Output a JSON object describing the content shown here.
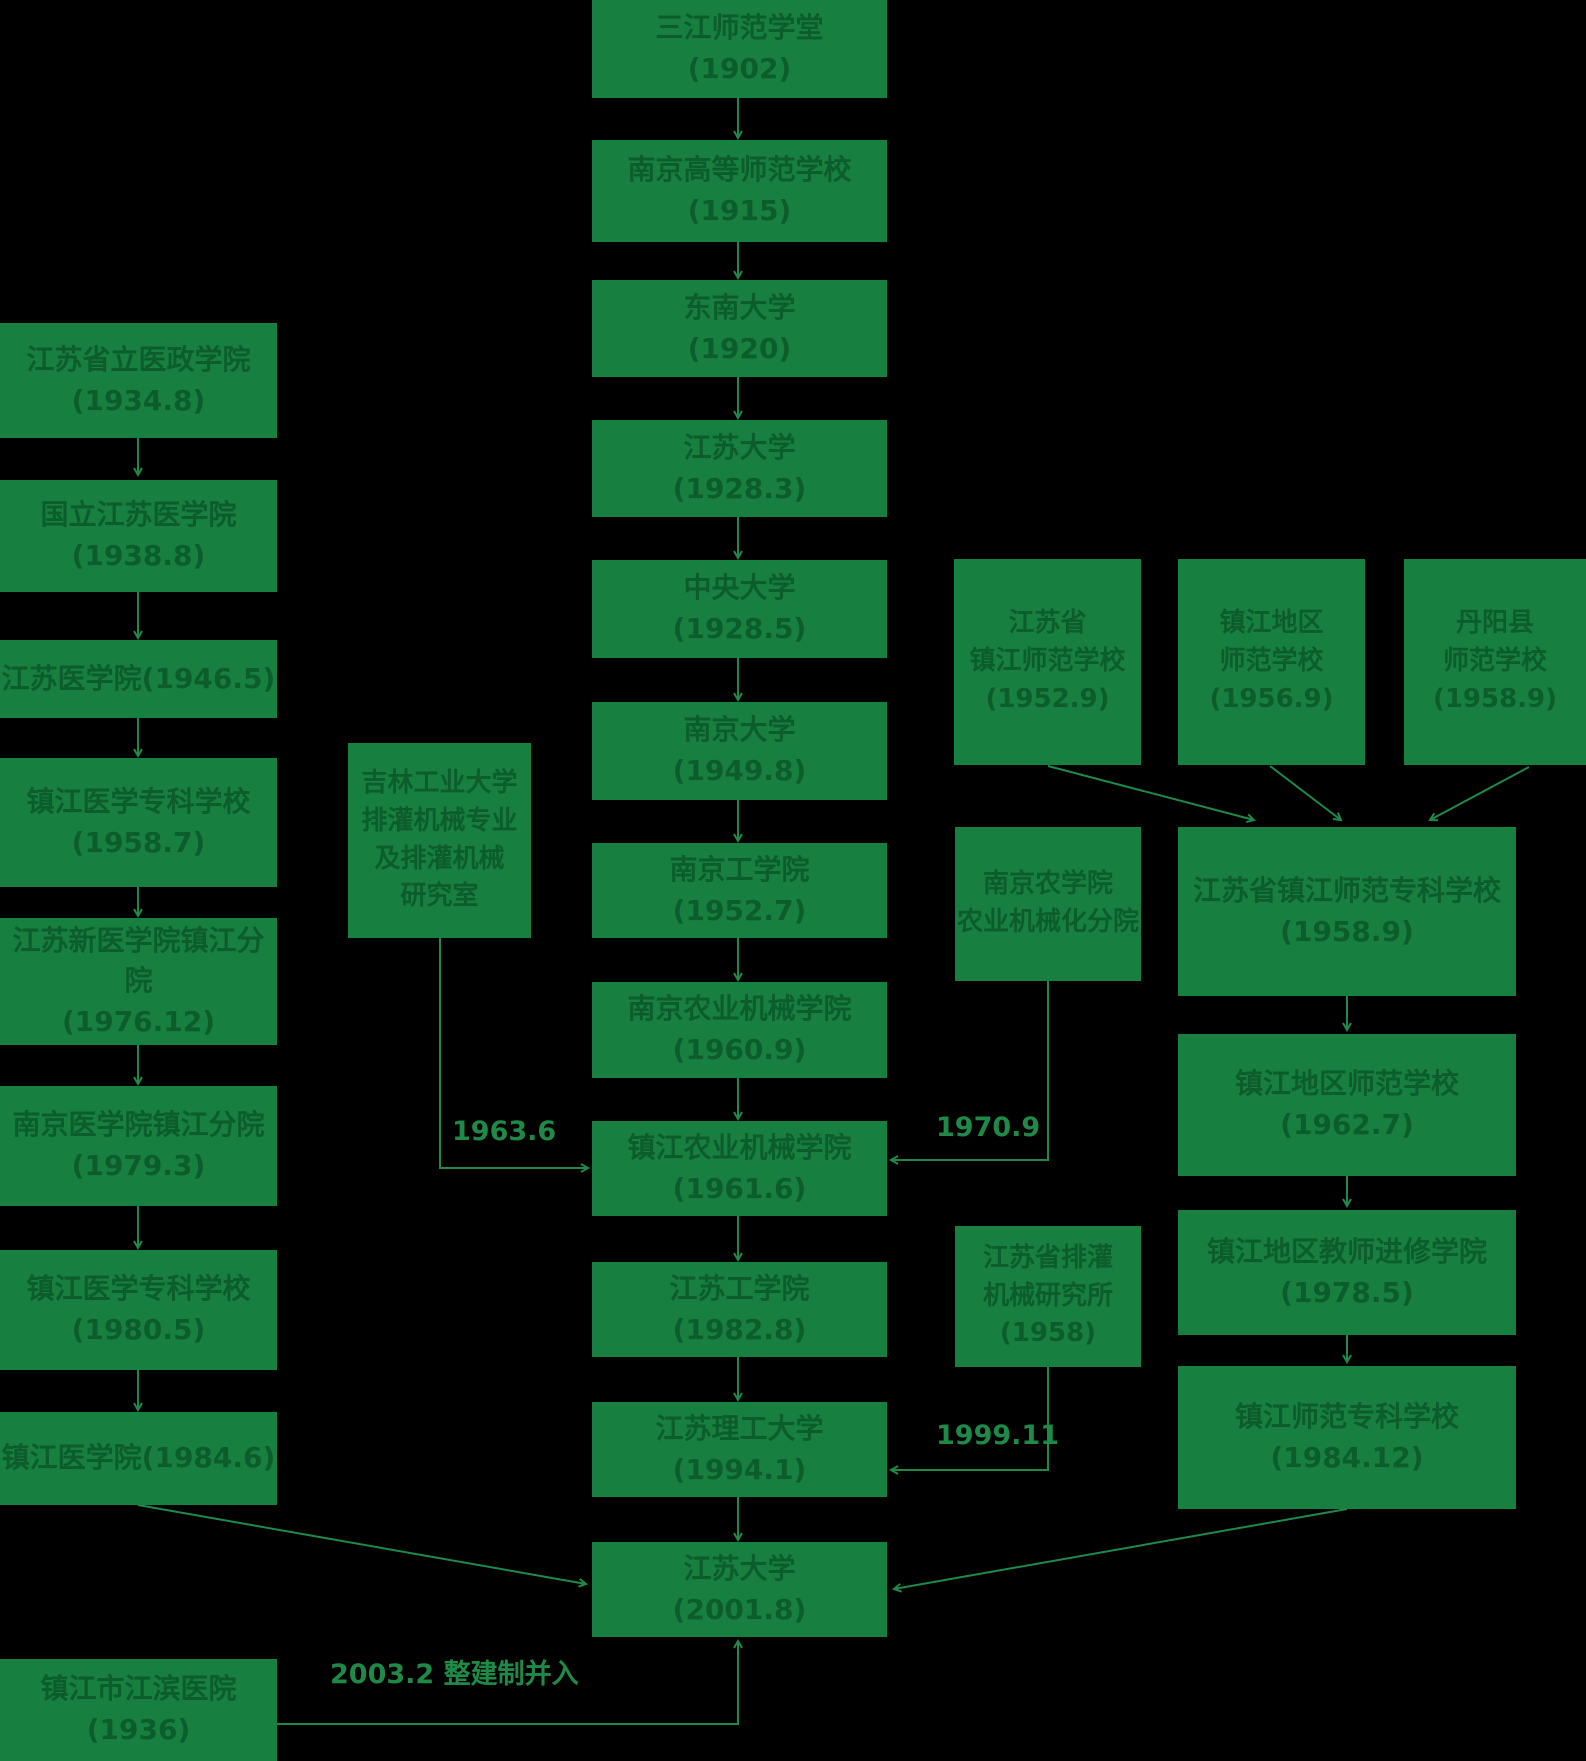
{
  "diagram": {
    "colors": {
      "background": "#000000",
      "node_fill": "#178040",
      "node_text": "#0d5c2b",
      "line": "#1f8a48"
    },
    "nodes": [
      {
        "id": "sanjiang-1902",
        "lines": [
          "三江师范学堂",
          "(1902)"
        ],
        "x": 592,
        "y": 0,
        "w": 295,
        "h": 98
      },
      {
        "id": "nanjing-gaoshi-1915",
        "lines": [
          "南京高等师范学校",
          "(1915)"
        ],
        "x": 592,
        "y": 140,
        "w": 295,
        "h": 102
      },
      {
        "id": "dongnan-1920",
        "lines": [
          "东南大学",
          "(1920)"
        ],
        "x": 592,
        "y": 280,
        "w": 295,
        "h": 97
      },
      {
        "id": "jiangsu-daxue-1928",
        "lines": [
          "江苏大学",
          "(1928.3)"
        ],
        "x": 592,
        "y": 420,
        "w": 295,
        "h": 97
      },
      {
        "id": "zhongyang-daxue-1928",
        "lines": [
          "中央大学",
          "(1928.5)"
        ],
        "x": 592,
        "y": 560,
        "w": 295,
        "h": 98
      },
      {
        "id": "nanjing-daxue-1949",
        "lines": [
          "南京大学",
          "(1949.8)"
        ],
        "x": 592,
        "y": 702,
        "w": 295,
        "h": 98
      },
      {
        "id": "nanjing-gongxueyuan-1952",
        "lines": [
          "南京工学院",
          "(1952.7)"
        ],
        "x": 592,
        "y": 843,
        "w": 295,
        "h": 95
      },
      {
        "id": "nanjing-nongji-1960",
        "lines": [
          "南京农业机械学院",
          "(1960.9)"
        ],
        "x": 592,
        "y": 982,
        "w": 295,
        "h": 96
      },
      {
        "id": "zhenjiang-nongji-1961",
        "lines": [
          "镇江农业机械学院",
          "(1961.6)"
        ],
        "x": 592,
        "y": 1121,
        "w": 295,
        "h": 95
      },
      {
        "id": "jiangsu-gongxueyuan-1982",
        "lines": [
          "江苏工学院",
          "(1982.8)"
        ],
        "x": 592,
        "y": 1262,
        "w": 295,
        "h": 95
      },
      {
        "id": "jiangsu-ligong-1994",
        "lines": [
          "江苏理工大学",
          "(1994.1)"
        ],
        "x": 592,
        "y": 1402,
        "w": 295,
        "h": 95
      },
      {
        "id": "jiangsu-daxue-2001",
        "lines": [
          "江苏大学",
          "(2001.8)"
        ],
        "x": 592,
        "y": 1542,
        "w": 295,
        "h": 95
      },
      {
        "id": "yizheng-xueyuan-1934",
        "lines": [
          "江苏省立医政学院",
          "(1934.8)"
        ],
        "x": 0,
        "y": 323,
        "w": 277,
        "h": 115
      },
      {
        "id": "guoli-jiangsu-yixueyuan-1938",
        "lines": [
          "国立江苏医学院",
          "(1938.8)"
        ],
        "x": 0,
        "y": 480,
        "w": 277,
        "h": 112
      },
      {
        "id": "jiangsu-yixueyuan-1946",
        "lines": [
          "江苏医学院(1946.5)"
        ],
        "x": 0,
        "y": 640,
        "w": 277,
        "h": 78
      },
      {
        "id": "zhenjiang-yizhuan-1958",
        "lines": [
          "镇江医学专科学校",
          "(1958.7)"
        ],
        "x": 0,
        "y": 758,
        "w": 277,
        "h": 129
      },
      {
        "id": "xinyi-zhenjiang-fenyuan-1976",
        "lines": [
          "江苏新医学院镇江分院",
          "(1976.12)"
        ],
        "x": 0,
        "y": 918,
        "w": 277,
        "h": 127
      },
      {
        "id": "nanyi-zhenjiang-fenyuan-1979",
        "lines": [
          "南京医学院镇江分院",
          "(1979.3)"
        ],
        "x": 0,
        "y": 1086,
        "w": 277,
        "h": 120
      },
      {
        "id": "zhenjiang-yizhuan-1980",
        "lines": [
          "镇江医学专科学校",
          "(1980.5)"
        ],
        "x": 0,
        "y": 1250,
        "w": 277,
        "h": 120
      },
      {
        "id": "zhenjiang-yixueyuan-1984",
        "lines": [
          "镇江医学院(1984.6)"
        ],
        "x": 0,
        "y": 1412,
        "w": 277,
        "h": 93
      },
      {
        "id": "jiangbin-yiyuan-1936",
        "lines": [
          "镇江市江滨医院",
          "(1936)"
        ],
        "x": 0,
        "y": 1659,
        "w": 277,
        "h": 102
      },
      {
        "id": "jilin-paiguan-1963",
        "lines": [
          "吉林工业大学",
          "排灌机械专业",
          "及排灌机械",
          "研究室"
        ],
        "x": 348,
        "y": 743,
        "w": 183,
        "h": 195
      },
      {
        "id": "zhenjiang-shifan-1952",
        "lines": [
          "江苏省",
          "镇江师范学校",
          "(1952.9)"
        ],
        "x": 954,
        "y": 559,
        "w": 187,
        "h": 206
      },
      {
        "id": "diqu-shifan-1956",
        "lines": [
          "镇江地区",
          "师范学校",
          "(1956.9)"
        ],
        "x": 1178,
        "y": 559,
        "w": 187,
        "h": 206
      },
      {
        "id": "danyang-shifan-1958",
        "lines": [
          "丹阳县",
          "师范学校",
          "(1958.9)"
        ],
        "x": 1404,
        "y": 559,
        "w": 182,
        "h": 206
      },
      {
        "id": "nongxueyuan-fenyuan",
        "lines": [
          "南京农学院",
          "农业机械化分院"
        ],
        "x": 955,
        "y": 827,
        "w": 186,
        "h": 154
      },
      {
        "id": "zhenjiang-shizhuan-1958",
        "lines": [
          "江苏省镇江师范专科学校",
          "(1958.9)"
        ],
        "x": 1178,
        "y": 827,
        "w": 338,
        "h": 169
      },
      {
        "id": "diqu-shifan-1962",
        "lines": [
          "镇江地区师范学校",
          "(1962.7)"
        ],
        "x": 1178,
        "y": 1034,
        "w": 338,
        "h": 142
      },
      {
        "id": "jiaoshi-jinxiu-1978",
        "lines": [
          "镇江地区教师进修学院",
          "(1978.5)"
        ],
        "x": 1178,
        "y": 1210,
        "w": 338,
        "h": 125
      },
      {
        "id": "zhenjiang-shizhuan-1984",
        "lines": [
          "镇江师范专科学校",
          "(1984.12)"
        ],
        "x": 1178,
        "y": 1366,
        "w": 338,
        "h": 143
      },
      {
        "id": "paiguan-yanjiusuo",
        "lines": [
          "江苏省排灌",
          "机械研究所",
          "(1958)"
        ],
        "x": 955,
        "y": 1226,
        "w": 186,
        "h": 141
      }
    ],
    "edges": [
      {
        "name": "sanjiang-to-gaoshi",
        "points": [
          [
            738,
            98
          ],
          [
            738,
            138
          ]
        ]
      },
      {
        "name": "gaoshi-to-dongnan",
        "points": [
          [
            738,
            242
          ],
          [
            738,
            278
          ]
        ]
      },
      {
        "name": "dongnan-to-jiangsudaxue",
        "points": [
          [
            738,
            377
          ],
          [
            738,
            418
          ]
        ]
      },
      {
        "name": "jiangsudaxue-to-zhongyang",
        "points": [
          [
            738,
            517
          ],
          [
            738,
            558
          ]
        ]
      },
      {
        "name": "zhongyang-to-nanjingdaxue",
        "points": [
          [
            738,
            658
          ],
          [
            738,
            700
          ]
        ]
      },
      {
        "name": "nanjingdaxue-to-gongxueyuan",
        "points": [
          [
            738,
            800
          ],
          [
            738,
            841
          ]
        ]
      },
      {
        "name": "gongxueyuan-to-nongji",
        "points": [
          [
            738,
            938
          ],
          [
            738,
            980
          ]
        ]
      },
      {
        "name": "nongji-to-zhenjiangnongji",
        "points": [
          [
            738,
            1078
          ],
          [
            738,
            1119
          ]
        ]
      },
      {
        "name": "zhenjiangnongji-to-gongxueyuan1982",
        "points": [
          [
            738,
            1216
          ],
          [
            738,
            1260
          ]
        ]
      },
      {
        "name": "gongxueyuan1982-to-ligong",
        "points": [
          [
            738,
            1357
          ],
          [
            738,
            1400
          ]
        ]
      },
      {
        "name": "ligong-to-jiangsudaxue2001",
        "points": [
          [
            738,
            1497
          ],
          [
            738,
            1540
          ]
        ]
      },
      {
        "name": "yizheng-to-guoli",
        "points": [
          [
            138,
            438
          ],
          [
            138,
            475
          ]
        ]
      },
      {
        "name": "guoli-to-yixueyuan",
        "points": [
          [
            138,
            592
          ],
          [
            138,
            638
          ]
        ]
      },
      {
        "name": "yixueyuan-to-yizhuan",
        "points": [
          [
            138,
            718
          ],
          [
            138,
            756
          ]
        ]
      },
      {
        "name": "yizhuan-to-xinyi",
        "points": [
          [
            138,
            887
          ],
          [
            138,
            916
          ]
        ]
      },
      {
        "name": "xinyi-to-nanyi",
        "points": [
          [
            138,
            1045
          ],
          [
            138,
            1084
          ]
        ]
      },
      {
        "name": "nanyi-to-yizhuan1980",
        "points": [
          [
            138,
            1206
          ],
          [
            138,
            1248
          ]
        ]
      },
      {
        "name": "yizhuan1980-to-yixueyuan1984",
        "points": [
          [
            138,
            1370
          ],
          [
            138,
            1410
          ]
        ]
      },
      {
        "name": "yixueyuan1984-to-jiangsudaxue2001",
        "points": [
          [
            138,
            1505
          ],
          [
            586,
            1584
          ]
        ]
      },
      {
        "name": "shizhuan1984-to-jiangsudaxue2001",
        "points": [
          [
            1347,
            1509
          ],
          [
            894,
            1589
          ]
        ]
      },
      {
        "name": "shifan1952-to-shizhuan",
        "points": [
          [
            1048,
            766
          ],
          [
            1254,
            820
          ]
        ]
      },
      {
        "name": "diqushifan-to-shizhuan",
        "points": [
          [
            1270,
            766
          ],
          [
            1341,
            820
          ]
        ]
      },
      {
        "name": "danyang-to-shizhuan",
        "points": [
          [
            1529,
            767
          ],
          [
            1430,
            820
          ]
        ]
      },
      {
        "name": "shizhuan-to-diqushifan1962",
        "points": [
          [
            1347,
            996
          ],
          [
            1347,
            1030
          ]
        ]
      },
      {
        "name": "diqushifan1962-to-jinxiu",
        "points": [
          [
            1347,
            1176
          ],
          [
            1347,
            1206
          ]
        ]
      },
      {
        "name": "jinxiu-to-shizhuan1984",
        "points": [
          [
            1347,
            1335
          ],
          [
            1347,
            1362
          ]
        ]
      },
      {
        "name": "jilin-1963-merge",
        "points": [
          [
            440,
            938
          ],
          [
            440,
            1168
          ],
          [
            588,
            1168
          ]
        ]
      },
      {
        "name": "fenyuan-1970-merge",
        "points": [
          [
            1048,
            981
          ],
          [
            1048,
            1160
          ],
          [
            891,
            1160
          ]
        ]
      },
      {
        "name": "yanjiusuo-1999-merge",
        "points": [
          [
            1048,
            1367
          ],
          [
            1048,
            1470
          ],
          [
            891,
            1470
          ]
        ]
      },
      {
        "name": "jiangbin-2003-merge",
        "points": [
          [
            277,
            1724
          ],
          [
            738,
            1724
          ],
          [
            738,
            1641
          ]
        ]
      }
    ],
    "edge_labels": [
      {
        "id": "label-1963",
        "text": "1963.6",
        "x": 452,
        "y": 1116
      },
      {
        "id": "label-1970",
        "text": "1970.9",
        "x": 936,
        "y": 1112
      },
      {
        "id": "label-1999",
        "text": "1999.11",
        "x": 936,
        "y": 1420
      },
      {
        "id": "label-2003",
        "text": "2003.2  整建制并入",
        "x": 330,
        "y": 1652
      }
    ]
  }
}
